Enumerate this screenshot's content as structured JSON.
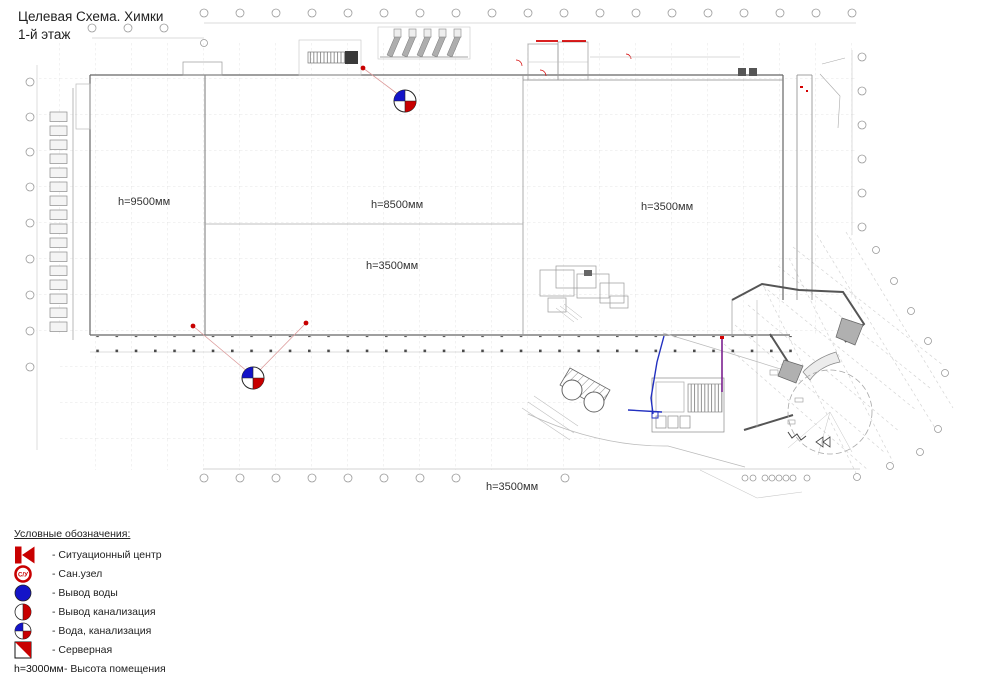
{
  "title": {
    "line1": "Целевая Схема. Химки",
    "line2": "1-й этаж"
  },
  "plan": {
    "height_labels": [
      {
        "text": "h=9500мм"
      },
      {
        "text": "h=8500мм"
      },
      {
        "text": "h=3500мм"
      },
      {
        "text": "h=3500мм"
      },
      {
        "text": "h=3500мм"
      }
    ],
    "markers": [
      {
        "type": "вода-канализация",
        "note": "quartered circle blue/red"
      },
      {
        "type": "вода-канализация",
        "note": "quartered circle blue/red"
      }
    ],
    "colors": {
      "accent_red": "#c80000",
      "accent_blue": "#1414c8",
      "wall_gray": "#666666",
      "grid_gray": "#d8d8d8",
      "purple_line": "#7b2090"
    }
  },
  "legend": {
    "header": "Условные обозначения:",
    "items": [
      {
        "icon": "situation-center",
        "label": "- Ситуационный центр"
      },
      {
        "icon": "san-uzel",
        "icon_text": "С/У",
        "label": "- Сан.узел"
      },
      {
        "icon": "water-outlet",
        "label": "- Вывод воды"
      },
      {
        "icon": "sewage-outlet",
        "label": "- Вывод канализация"
      },
      {
        "icon": "water-sewage",
        "label": "- Вода, канализация"
      },
      {
        "icon": "server-room",
        "label": "- Серверная"
      },
      {
        "icon": "height-text",
        "icon_text": "h=3000мм",
        "label": "- Высота помещения"
      }
    ]
  }
}
